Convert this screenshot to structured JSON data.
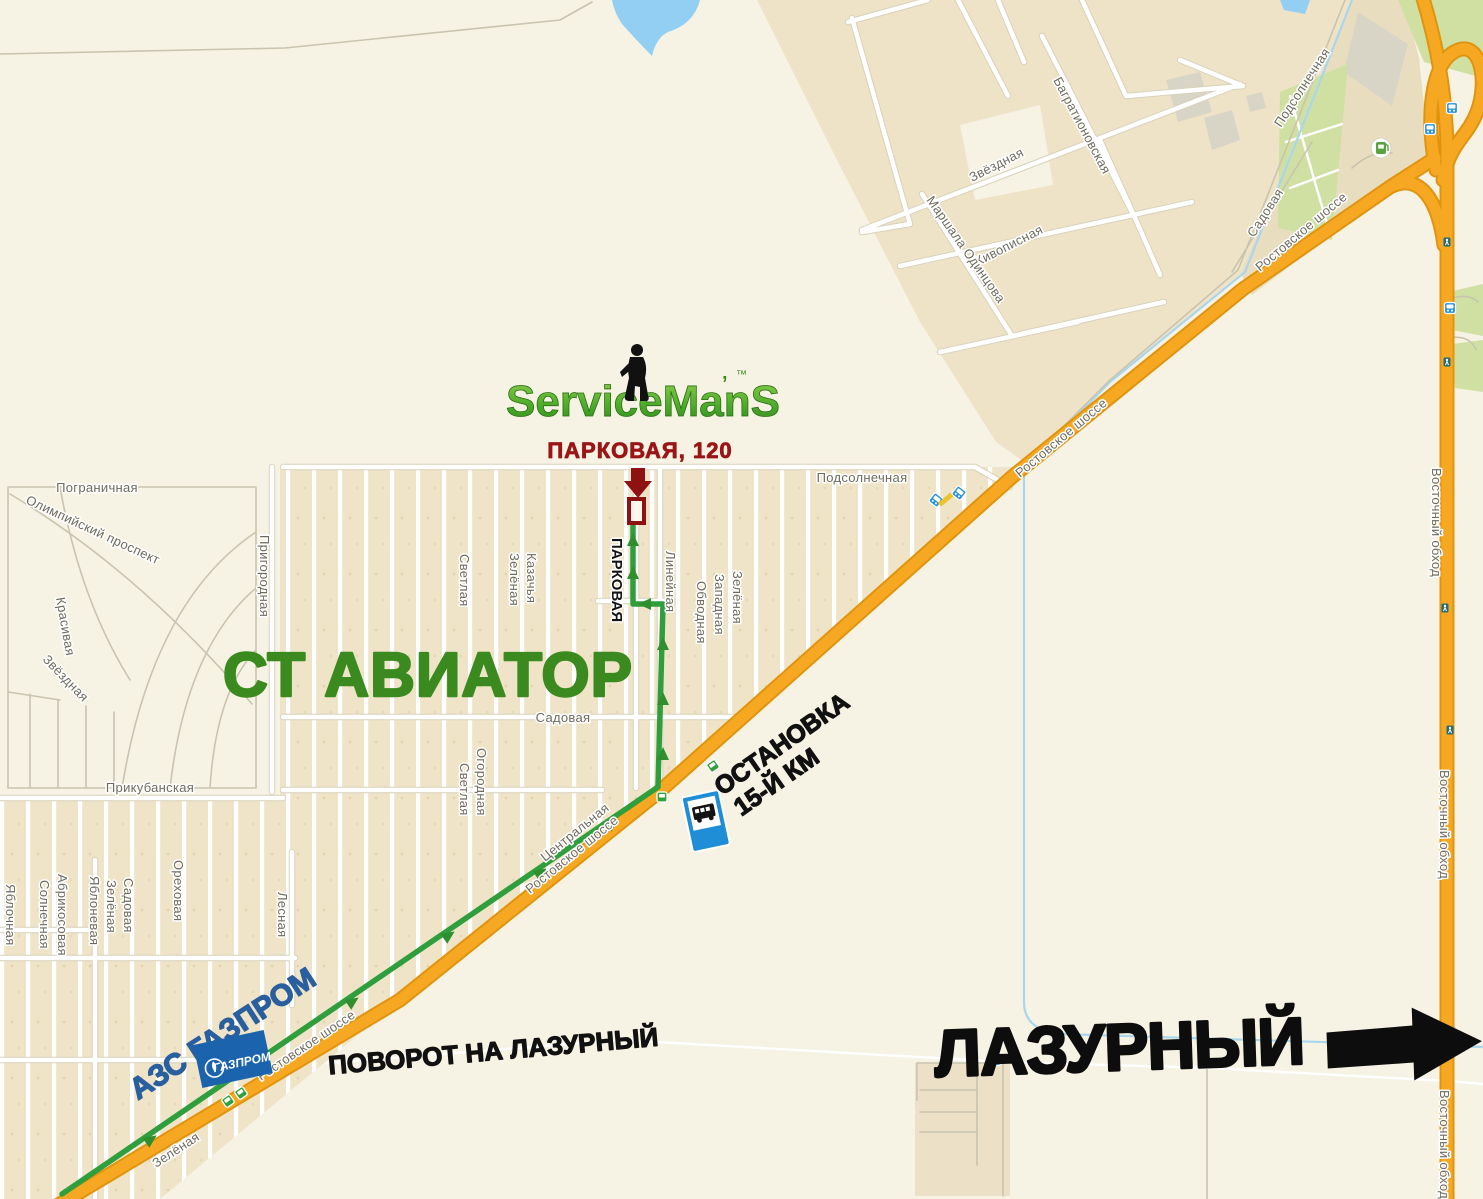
{
  "map": {
    "brand": {
      "logo_text": "ServiceManS",
      "apostrophe": "’",
      "trademark": "™",
      "address_label": "ПАРКОВАЯ, 120"
    },
    "areas": {
      "st_aviator": "СТ АВИАТОР"
    },
    "poi": {
      "bus_stop_title": "ОСТАНОВКА",
      "bus_stop_subtitle": "15-Й КМ",
      "gas_station_label": "АЗС ГАЗПРОМ",
      "gazprom_logo_text": "ГАЗПРОМ",
      "turn_label": "ПОВОРОТ НА ЛАЗУРНЫЙ",
      "destination_label": "ЛАЗУРНЫЙ"
    },
    "streets": {
      "pogranichnaya": "Пограничная",
      "olimpiyskiy_prospekt": "Олимпийский проспект",
      "krasivaya": "Красивая",
      "zvyozdnaya_w": "Звёздная",
      "prigorodnaya": "Пригородная",
      "prikubanskaya": "Прикубанская",
      "yablochnaya": "Яблочная",
      "solnechnaya": "Солнечная",
      "abrikosovaya": "Абрикосовая",
      "yablonevaya": "Яблоневая",
      "zelyonaya_sw": "Зелёная",
      "sadovaya_sw": "Садовая",
      "orekhovaya": "Ореховая",
      "lesnaya": "Лесная",
      "zelyonaya_s": "Зелёная",
      "svetlaya_n": "Светлая",
      "zelyonaya_c": "Зелёная",
      "kazachya": "Казачья",
      "parkovaya": "ПАРКОВАЯ",
      "lineynaya": "Линейная",
      "obvodnaya": "Обводная",
      "zapadnaya": "Западная",
      "zelyonaya_e": "Зелёная",
      "svetlaya_s": "Светлая",
      "ogorodnaya": "Огородная",
      "sadovaya_c": "Садовая",
      "podsolnechnaya_c": "Подсолнечная",
      "tsentralnaya": "Центральная",
      "bagrationovskaya": "Багратионовская",
      "zvyozdnaya_n": "Звёздная",
      "zhivopisnaya": "Живописная",
      "marshala_odintsova": "Маршала Одинцова",
      "podsolnechnaya_ne": "Подсолнечная",
      "sadovaya_ne": "Садовая",
      "rostovskoye_shosse": "Ростовское шоссе",
      "vostochny_obkhod": "Восточный обход"
    },
    "colors": {
      "background_ivory": "#f7f3e4",
      "allotment_beige": "#efe4c7",
      "highway_orange": "#f7a823",
      "highway_casing": "#e0940e",
      "route_green": "#2f9e3c",
      "aviator_green": "#3a8a1f",
      "brand_green_light": "#8fce4e",
      "brand_green_dark": "#2f8a1d",
      "address_red": "#9a1616",
      "gazprom_blue": "#1b64ad",
      "gas_label_blue": "#2a5f9f",
      "bus_sign_blue": "#1f8ed6",
      "water_blue": "#93cff2",
      "label_gray": "#6e6b5e",
      "black": "#111111"
    }
  }
}
